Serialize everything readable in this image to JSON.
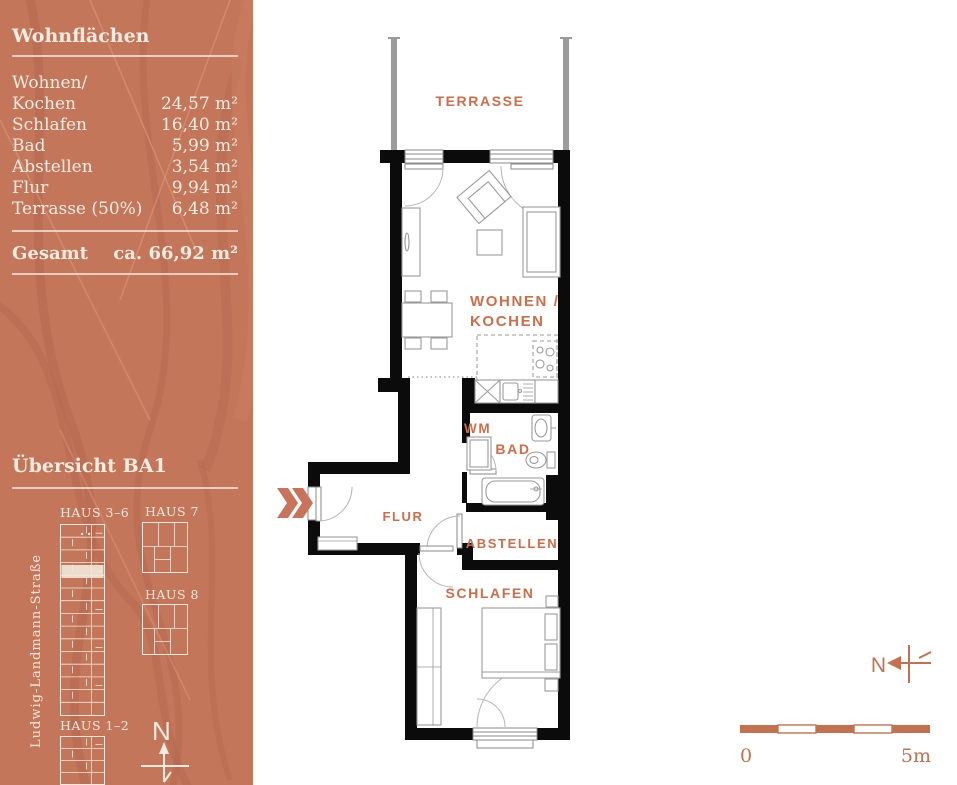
{
  "sidebar": {
    "areas_title": "Wohnflächen",
    "rows": [
      {
        "label": "Wohnen/",
        "value": ""
      },
      {
        "label": "Kochen",
        "value": "24,57 m²"
      },
      {
        "label": "Schlafen",
        "value": "16,40 m²"
      },
      {
        "label": "Bad",
        "value": "5,99 m²"
      },
      {
        "label": "Abstellen",
        "value": "3,54 m²"
      },
      {
        "label": "Flur",
        "value": "9,94 m²"
      },
      {
        "label": "Terrasse (50%)",
        "value": "6,48 m²"
      }
    ],
    "total_label": "Gesamt",
    "total_value": "ca. 66,92 m²",
    "overview_title": "Übersicht BA1",
    "street_label": "Ludwig-Landmann-Straße",
    "buildings": [
      {
        "label": "HAUS 3–6"
      },
      {
        "label": "HAUS 7"
      },
      {
        "label": "HAUS 8"
      },
      {
        "label": "HAUS 1–2"
      }
    ],
    "north_label": "N"
  },
  "plan": {
    "terrasse": "TERRASSE",
    "wohnen_line1": "WOHNEN /",
    "wohnen_line2": "KOCHEN",
    "wm": "WM",
    "bad": "BAD",
    "flur": "FLUR",
    "abstellen": "ABSTELLEN",
    "schlafen": "SCHLAFEN",
    "compass_label": "N"
  },
  "scalebar": {
    "zero": "0",
    "five": "5m"
  },
  "colors": {
    "sidebar_bg": "#C4765A",
    "branch_dark": "#B2674E",
    "branch_light": "#DA977C",
    "cream_text": "#F4ECE1",
    "room_label_orange": "#CE6E49",
    "scale_terracotta": "#C3714F",
    "wall_black": "#0b0b0b",
    "highlight_unit": "#EFE2D3"
  }
}
